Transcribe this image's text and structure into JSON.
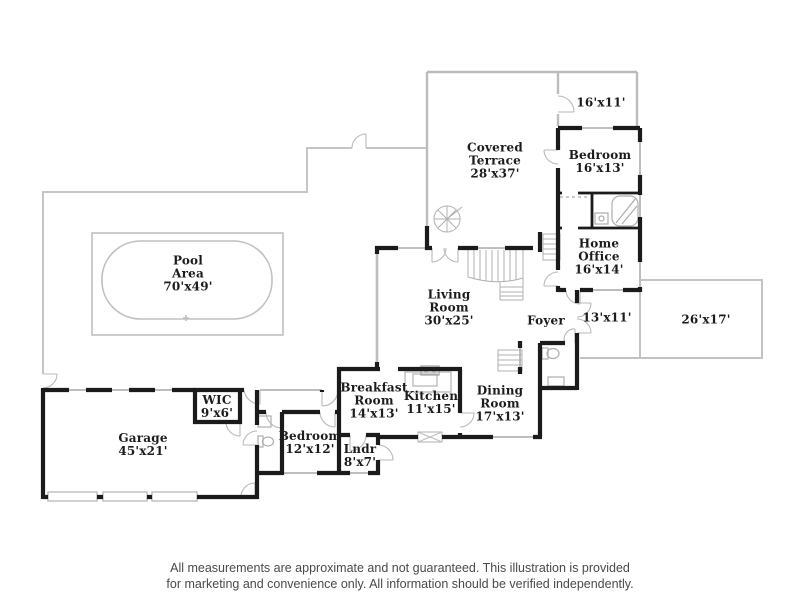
{
  "plan": {
    "rooms": {
      "pool_area": {
        "label": "Pool\nArea\n70'x49'"
      },
      "covered_terrace": {
        "label": "Covered\nTerrace\n28'x37'"
      },
      "balcony": {
        "label": "16'x11'"
      },
      "bedroom_upper": {
        "label": "Bedroom\n16'x13'"
      },
      "home_office": {
        "label": "Home\nOffice\n16'x14'"
      },
      "living_room": {
        "label": "Living\nRoom\n30'x25'"
      },
      "foyer": {
        "label": "Foyer"
      },
      "entry_porch": {
        "label": "13'x11'"
      },
      "driveway": {
        "label": "26'x17'"
      },
      "breakfast_room": {
        "label": "Breakfast\nRoom\n14'x13'"
      },
      "kitchen": {
        "label": "Kitchen\n11'x15'"
      },
      "dining_room": {
        "label": "Dining\nRoom\n17'x13'"
      },
      "wic": {
        "label": "WIC\n9'x6'"
      },
      "bedroom_lower": {
        "label": "Bedroom\n12'x12'"
      },
      "laundry": {
        "label": "Lndr\n8'x7'"
      },
      "garage": {
        "label": "Garage\n45'x21'"
      }
    },
    "disclaimer": {
      "line1": "All measurements are approximate and not guaranteed. This illustration is provided",
      "line2": "for marketing and convenience only. All information should be verified independently."
    },
    "colors": {
      "wall": "#1b1b1b",
      "outline": "#c0c0c0",
      "label_text": "#1b1b1b",
      "disclaimer_text": "#4a4a4a",
      "background": "#ffffff"
    }
  }
}
